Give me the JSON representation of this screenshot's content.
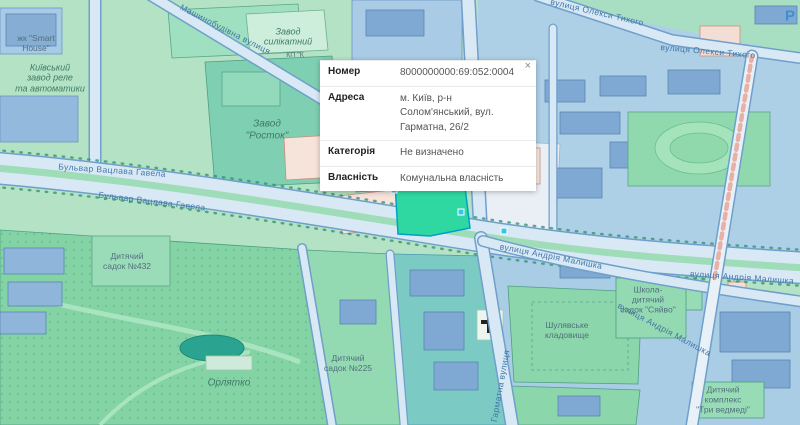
{
  "popup": {
    "close_label": "×",
    "rows": [
      {
        "label": "Номер",
        "value": "8000000000:69:052:0004"
      },
      {
        "label": "Адреса",
        "value": "м. Київ, р-н Солом'янський, вул. Гарматна, 26/2"
      },
      {
        "label": "Категорія",
        "value": "Не визначено"
      },
      {
        "label": "Власність",
        "value": "Комунальна власність"
      }
    ]
  },
  "map": {
    "colors": {
      "selected_parcel": "#2fd8a0",
      "vertex_handle": "#35c6ea",
      "road_label": "#4377a5",
      "base_green": "#b4e2c4",
      "building_blue": "#7fa9d2",
      "building_pink": "#f6e3da"
    },
    "labels": [
      {
        "text": "жк \"Smart\nHouse\""
      },
      {
        "text": "Київський\nзавод реле\nта автоматики"
      },
      {
        "text": "Завод\nсилікатний"
      },
      {
        "text": "КП \"К"
      },
      {
        "text": "Завод\n\"Росток\""
      },
      {
        "text": "Машинобудівна вулиця"
      },
      {
        "text": "вулиця Олекси Тихого"
      },
      {
        "text": "вулиця Олекси Тихого"
      },
      {
        "text": "Бульвар Вацлава Гавела"
      },
      {
        "text": "Бульвар Вацлава Гавела"
      },
      {
        "text": "вулиця Андрія Малишка"
      },
      {
        "text": "вулиця Андрія Малишка"
      },
      {
        "text": "вулиця Андрія Малишка"
      },
      {
        "text": "Гарматна вулиця"
      },
      {
        "text": "Орлятко"
      },
      {
        "text": "Дитячий\nсадок №432"
      },
      {
        "text": "Дитячий\nсадок №225"
      },
      {
        "text": "Шулявське\nкладовище"
      },
      {
        "text": "Школа-\nдитячий\nсадок \"Сяйво\""
      },
      {
        "text": "Дитячий\nкомплекс\n\"Три ведмеді\""
      },
      {
        "text": "P"
      }
    ]
  }
}
